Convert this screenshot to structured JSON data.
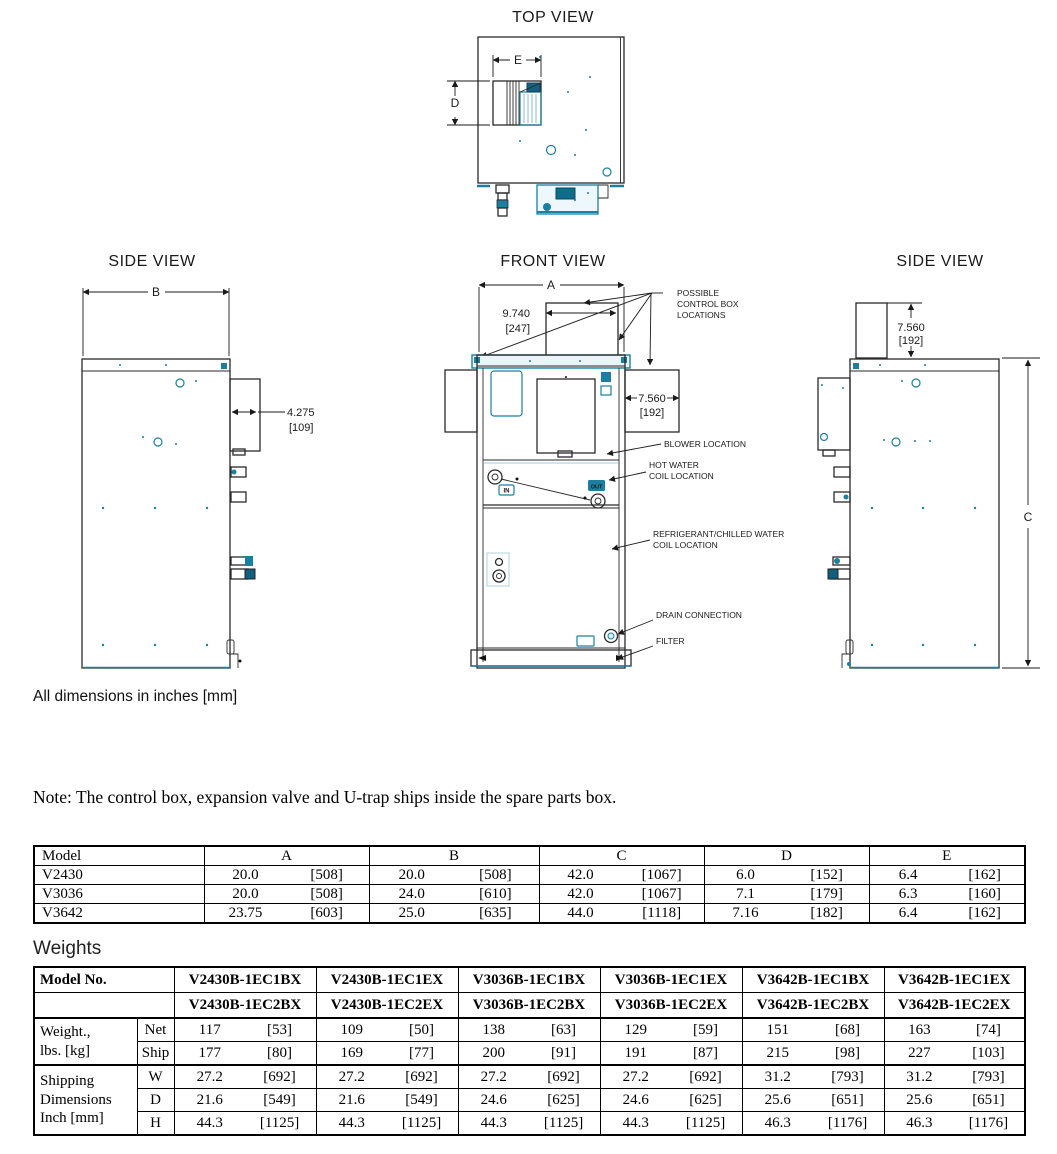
{
  "views": {
    "top": {
      "title": "TOP VIEW",
      "dim_e": "E",
      "dim_d": "D"
    },
    "side_left": {
      "title": "SIDE VIEW",
      "dim_b": "B",
      "dim_depth": "4.275",
      "dim_depth_mm": "[109]"
    },
    "front": {
      "title": "FRONT VIEW",
      "dim_a": "A",
      "dim_duct_w": "9.740",
      "dim_duct_w_mm": "[247]",
      "dim_box_w": "7.560",
      "dim_box_w_mm": "[192]",
      "in_label": "IN",
      "out_label": "OUT",
      "callout_control_1": "POSSIBLE",
      "callout_control_2": "CONTROL BOX",
      "callout_control_3": "LOCATIONS",
      "callout_blower": "BLOWER LOCATION",
      "callout_hw_1": "HOT WATER",
      "callout_hw_2": "COIL LOCATION",
      "callout_ref_1": "REFRIGERANT/CHILLED WATER",
      "callout_ref_2": "COIL LOCATION",
      "callout_drain": "DRAIN CONNECTION",
      "callout_filter": "FILTER"
    },
    "side_right": {
      "title": "SIDE VIEW",
      "dim_duct_h": "7.560",
      "dim_duct_h_mm": "[192]",
      "dim_c": "C"
    },
    "units_note": "All dimensions in inches [mm]"
  },
  "note": "Note: The control box, expansion valve and U-trap ships inside the spare parts box.",
  "dim_table": {
    "headers": [
      "Model",
      "A",
      "B",
      "C",
      "D",
      "E"
    ],
    "rows": [
      {
        "model": "V2430",
        "a": [
          "20.0",
          "[508]"
        ],
        "b": [
          "20.0",
          "[508]"
        ],
        "c": [
          "42.0",
          "[1067]"
        ],
        "d": [
          "6.0",
          "[152]"
        ],
        "e": [
          "6.4",
          "[162]"
        ]
      },
      {
        "model": "V3036",
        "a": [
          "20.0",
          "[508]"
        ],
        "b": [
          "24.0",
          "[610]"
        ],
        "c": [
          "42.0",
          "[1067]"
        ],
        "d": [
          "7.1",
          "[179]"
        ],
        "e": [
          "6.3",
          "[160]"
        ]
      },
      {
        "model": "V3642",
        "a": [
          "23.75",
          "[603]"
        ],
        "b": [
          "25.0",
          "[635]"
        ],
        "c": [
          "44.0",
          "[1118]"
        ],
        "d": [
          "7.16",
          "[182]"
        ],
        "e": [
          "6.4",
          "[162]"
        ]
      }
    ]
  },
  "weights": {
    "title": "Weights",
    "model_no": "Model No.",
    "cols": [
      [
        "V2430B-1EC1BX",
        "V2430B-1EC2BX"
      ],
      [
        "V2430B-1EC1EX",
        "V2430B-1EC2EX"
      ],
      [
        "V3036B-1EC1BX",
        "V3036B-1EC2BX"
      ],
      [
        "V3036B-1EC1EX",
        "V3036B-1EC2EX"
      ],
      [
        "V3642B-1EC1BX",
        "V3642B-1EC2BX"
      ],
      [
        "V3642B-1EC1EX",
        "V3642B-1EC2EX"
      ]
    ],
    "group_weight_1": "Weight.,",
    "group_weight_2": "lbs. [kg]",
    "group_ship_1": "Shipping",
    "group_ship_2": "Dimensions",
    "group_ship_3": "Inch [mm]",
    "rows": [
      {
        "label": "Net",
        "v": [
          [
            "117",
            "[53]"
          ],
          [
            "109",
            "[50]"
          ],
          [
            "138",
            "[63]"
          ],
          [
            "129",
            "[59]"
          ],
          [
            "151",
            "[68]"
          ],
          [
            "163",
            "[74]"
          ]
        ]
      },
      {
        "label": "Ship",
        "v": [
          [
            "177",
            "[80]"
          ],
          [
            "169",
            "[77]"
          ],
          [
            "200",
            "[91]"
          ],
          [
            "191",
            "[87]"
          ],
          [
            "215",
            "[98]"
          ],
          [
            "227",
            "[103]"
          ]
        ]
      },
      {
        "label": "W",
        "v": [
          [
            "27.2",
            "[692]"
          ],
          [
            "27.2",
            "[692]"
          ],
          [
            "27.2",
            "[692]"
          ],
          [
            "27.2",
            "[692]"
          ],
          [
            "31.2",
            "[793]"
          ],
          [
            "31.2",
            "[793]"
          ]
        ]
      },
      {
        "label": "D",
        "v": [
          [
            "21.6",
            "[549]"
          ],
          [
            "21.6",
            "[549]"
          ],
          [
            "24.6",
            "[625]"
          ],
          [
            "24.6",
            "[625]"
          ],
          [
            "25.6",
            "[651]"
          ],
          [
            "25.6",
            "[651]"
          ]
        ]
      },
      {
        "label": "H",
        "v": [
          [
            "44.3",
            "[1125]"
          ],
          [
            "44.3",
            "[1125]"
          ],
          [
            "44.3",
            "[1125]"
          ],
          [
            "44.3",
            "[1125]"
          ],
          [
            "46.3",
            "[1176]"
          ],
          [
            "46.3",
            "[1176]"
          ]
        ]
      }
    ]
  },
  "colors": {
    "accent_teal": "#1a7fa0",
    "line": "#2a2a2a"
  }
}
